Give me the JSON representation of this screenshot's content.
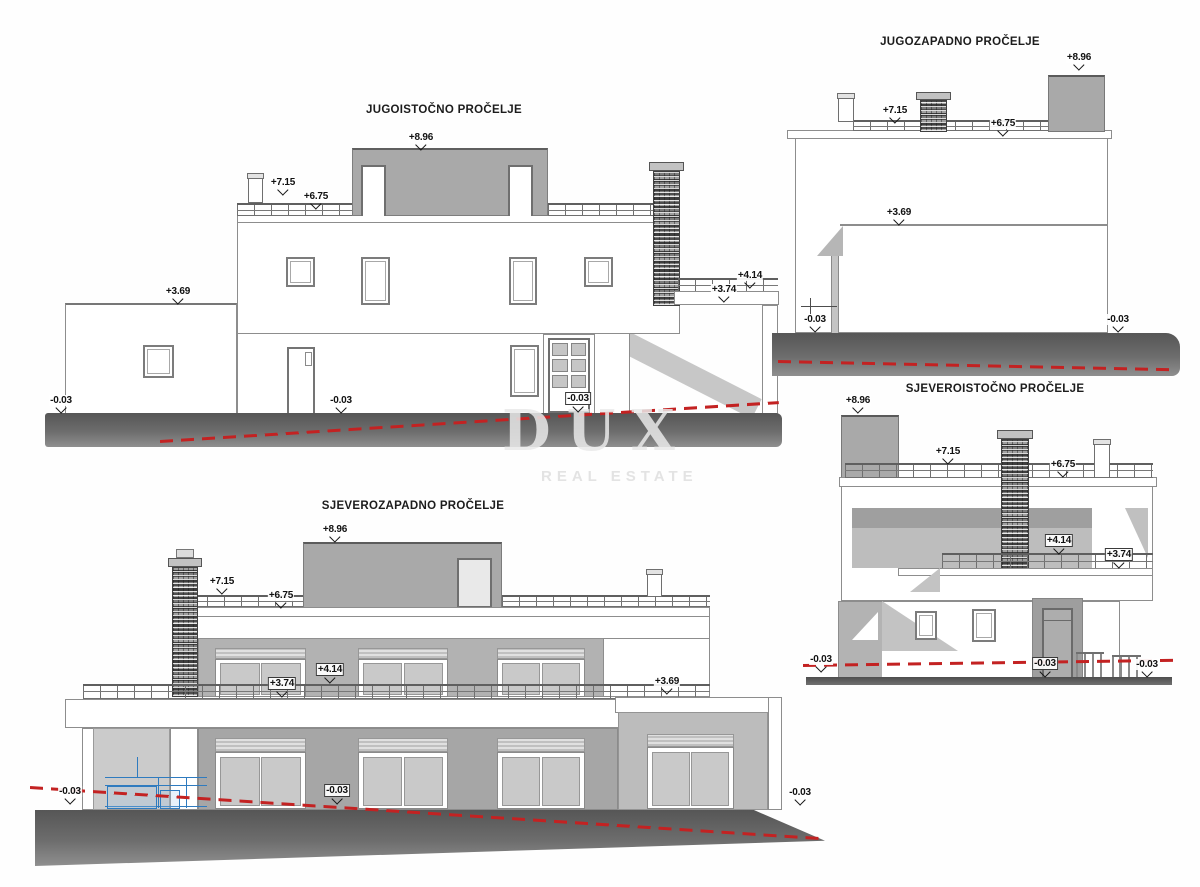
{
  "sheet": {
    "background": "#fefefe"
  },
  "watermark": {
    "brand": "DUX",
    "tagline": "REAL ESTATE"
  },
  "colors": {
    "ground_strip": "#6d6d6d",
    "terrain_line_red": "#c32222",
    "equipment_blue": "#2f7bbf",
    "facade_gray": "#a9a9a9",
    "text": "#1c1c1c"
  },
  "elevations": [
    {
      "id": "jugoistocno",
      "title": "JUGOISTOČNO PROČELJE",
      "markers": [
        "+8.96",
        "+7.15",
        "+6.75",
        "+3.69",
        "+4.14",
        "+3.74",
        "-0.03",
        "-0.03",
        "-0.03"
      ]
    },
    {
      "id": "jugozapadno",
      "title": "JUGOZAPADNO PROČELJE",
      "markers": [
        "+8.96",
        "+7.15",
        "+6.75",
        "+3.69",
        "-0.03",
        "-0.03"
      ]
    },
    {
      "id": "sjeverozapadno",
      "title": "SJEVEROZAPADNO PROČELJE",
      "markers": [
        "+8.96",
        "+7.15",
        "+6.75",
        "+4.14",
        "+3.74",
        "+3.69",
        "-0.03",
        "-0.03",
        "-0.03"
      ]
    },
    {
      "id": "sjeveroistocno",
      "title": "SJEVEROISTOČNO PROČELJE",
      "markers": [
        "+8.96",
        "+7.15",
        "+6.75",
        "+4.14",
        "+3.74",
        "-0.03",
        "-0.03",
        "-0.03"
      ]
    }
  ]
}
